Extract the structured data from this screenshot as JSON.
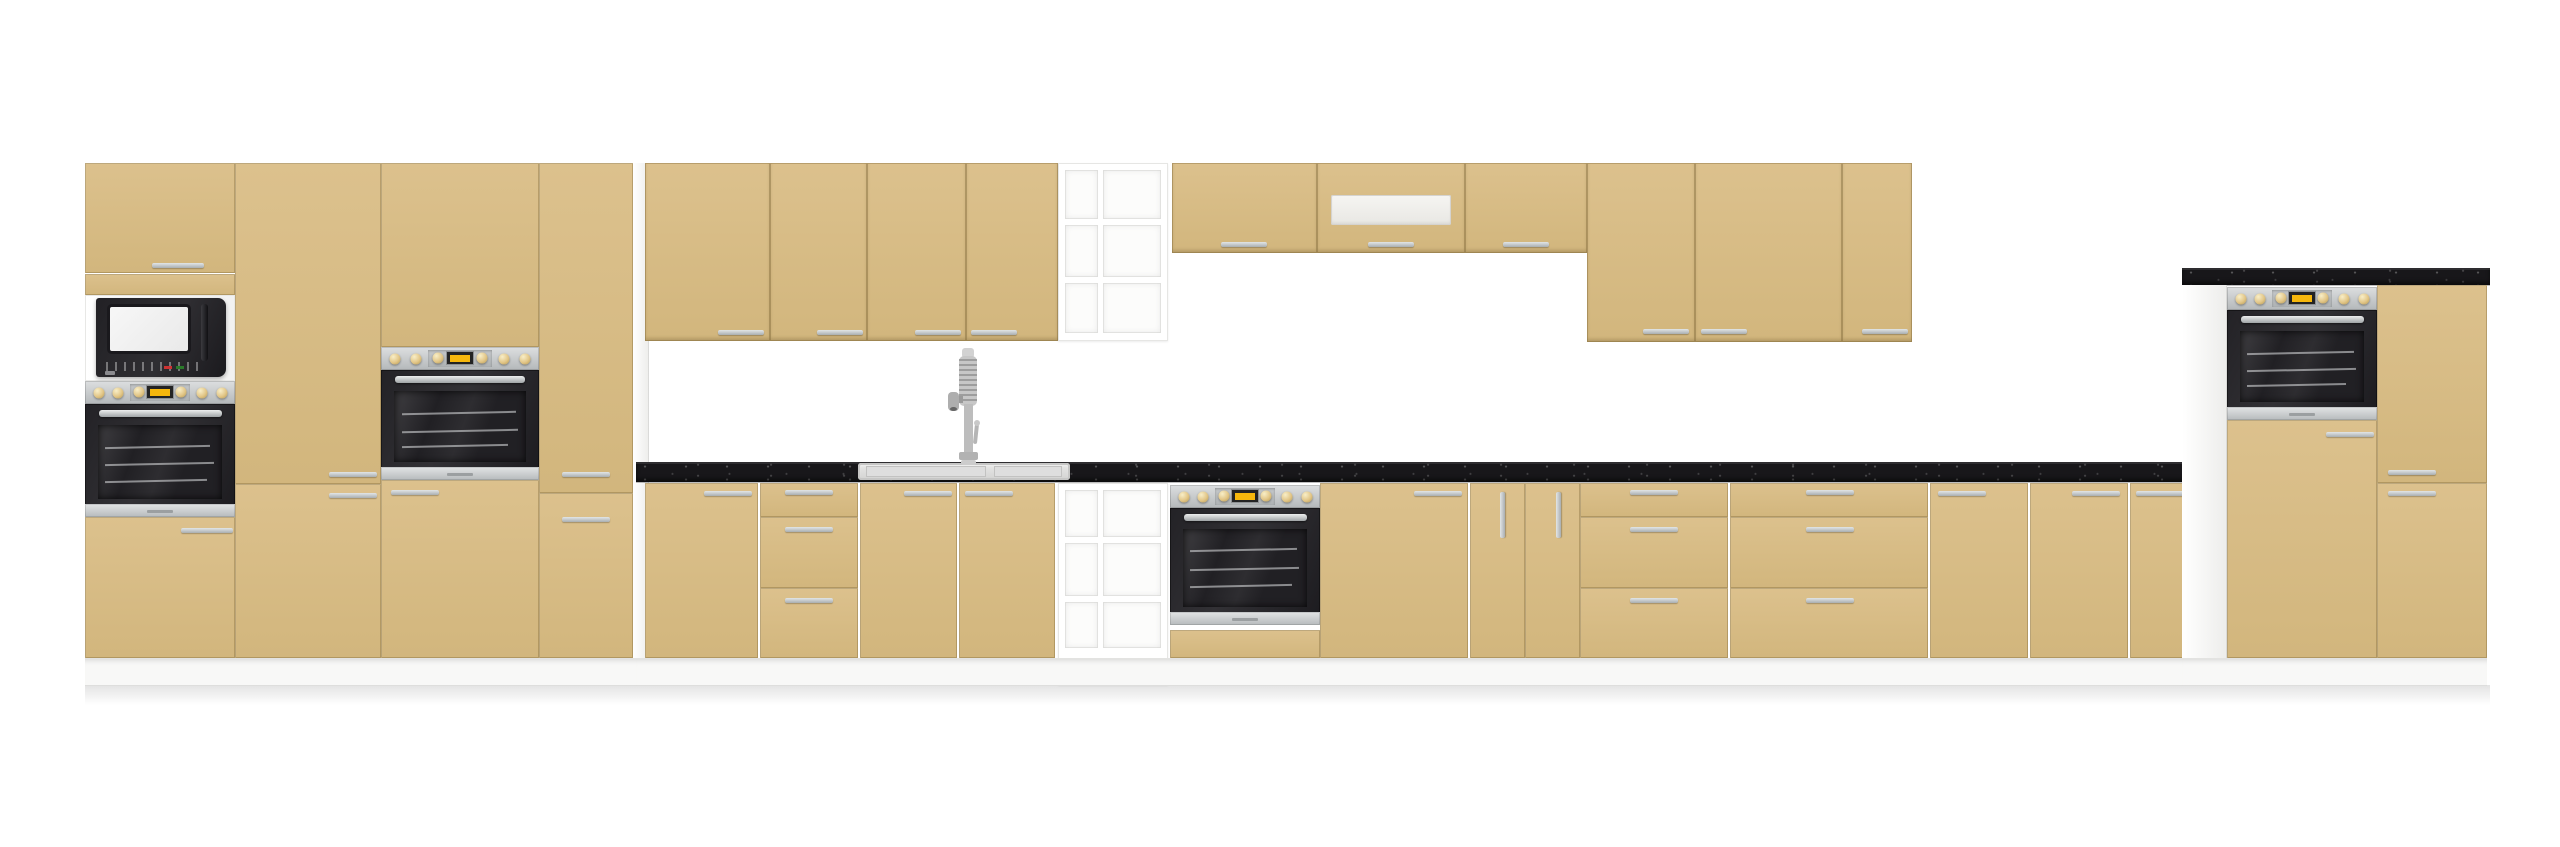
{
  "scene": {
    "kind": "product-render",
    "subject": "Modular kitchen furniture set with cappuccino-beige fronts, white carcasses and black stone-effect worktops",
    "background_color": "#ffffff"
  },
  "colors": {
    "bg": "#ffffff",
    "front": "#dcc18d",
    "front2": "#d2b67d",
    "panel": "#ededeb",
    "plinth": "#f8f8f7",
    "counter": "#18171a",
    "display": "#f6b70c"
  },
  "sections": {
    "left_tall": {
      "label": "Left tall cabinet section: microwave + oven column, pantry column, second oven column, narrow tall column"
    },
    "wall_row_left": {
      "label": "Wall cabinet row with four doors"
    },
    "open_shelf_upper": {
      "label": "Open white shelf unit (upper, 6 cubbies)"
    },
    "wall_row_short": {
      "label": "Short wall cabinet row with extractor hood cabinet"
    },
    "wall_row_right": {
      "label": "Tall wall cabinet row with three doors"
    },
    "base_run": {
      "label": "Base cabinet run with black worktop, sink, drawers and built-in oven"
    },
    "open_shelf_lower": {
      "label": "Open white shelf unit (lower, 6 cubbies)"
    },
    "right_tall": {
      "label": "Right tall oven housing with worktop and drawer column"
    }
  },
  "appliances": {
    "microwave": {
      "label": "Built-in microwave with white window"
    },
    "oven_left": {
      "label": "Built-in oven below microwave"
    },
    "oven_mid": {
      "label": "Built-in oven in mid tall column"
    },
    "oven_base": {
      "label": "Built-in oven under worktop"
    },
    "oven_right": {
      "label": "Built-in oven in right housing"
    },
    "sink": {
      "label": "Inset rectangular sink"
    },
    "faucet": {
      "label": "Chrome spring pull-out faucet"
    },
    "hood_vent": {
      "label": "Extractor hood vent strip"
    }
  },
  "counts": {
    "tall_columns_left": 4,
    "wall_doors": 10,
    "base_fronts": 14,
    "drawer_stacks": 3,
    "ovens": 4,
    "microwaves": 1,
    "open_shelf_cubbies": 12
  }
}
